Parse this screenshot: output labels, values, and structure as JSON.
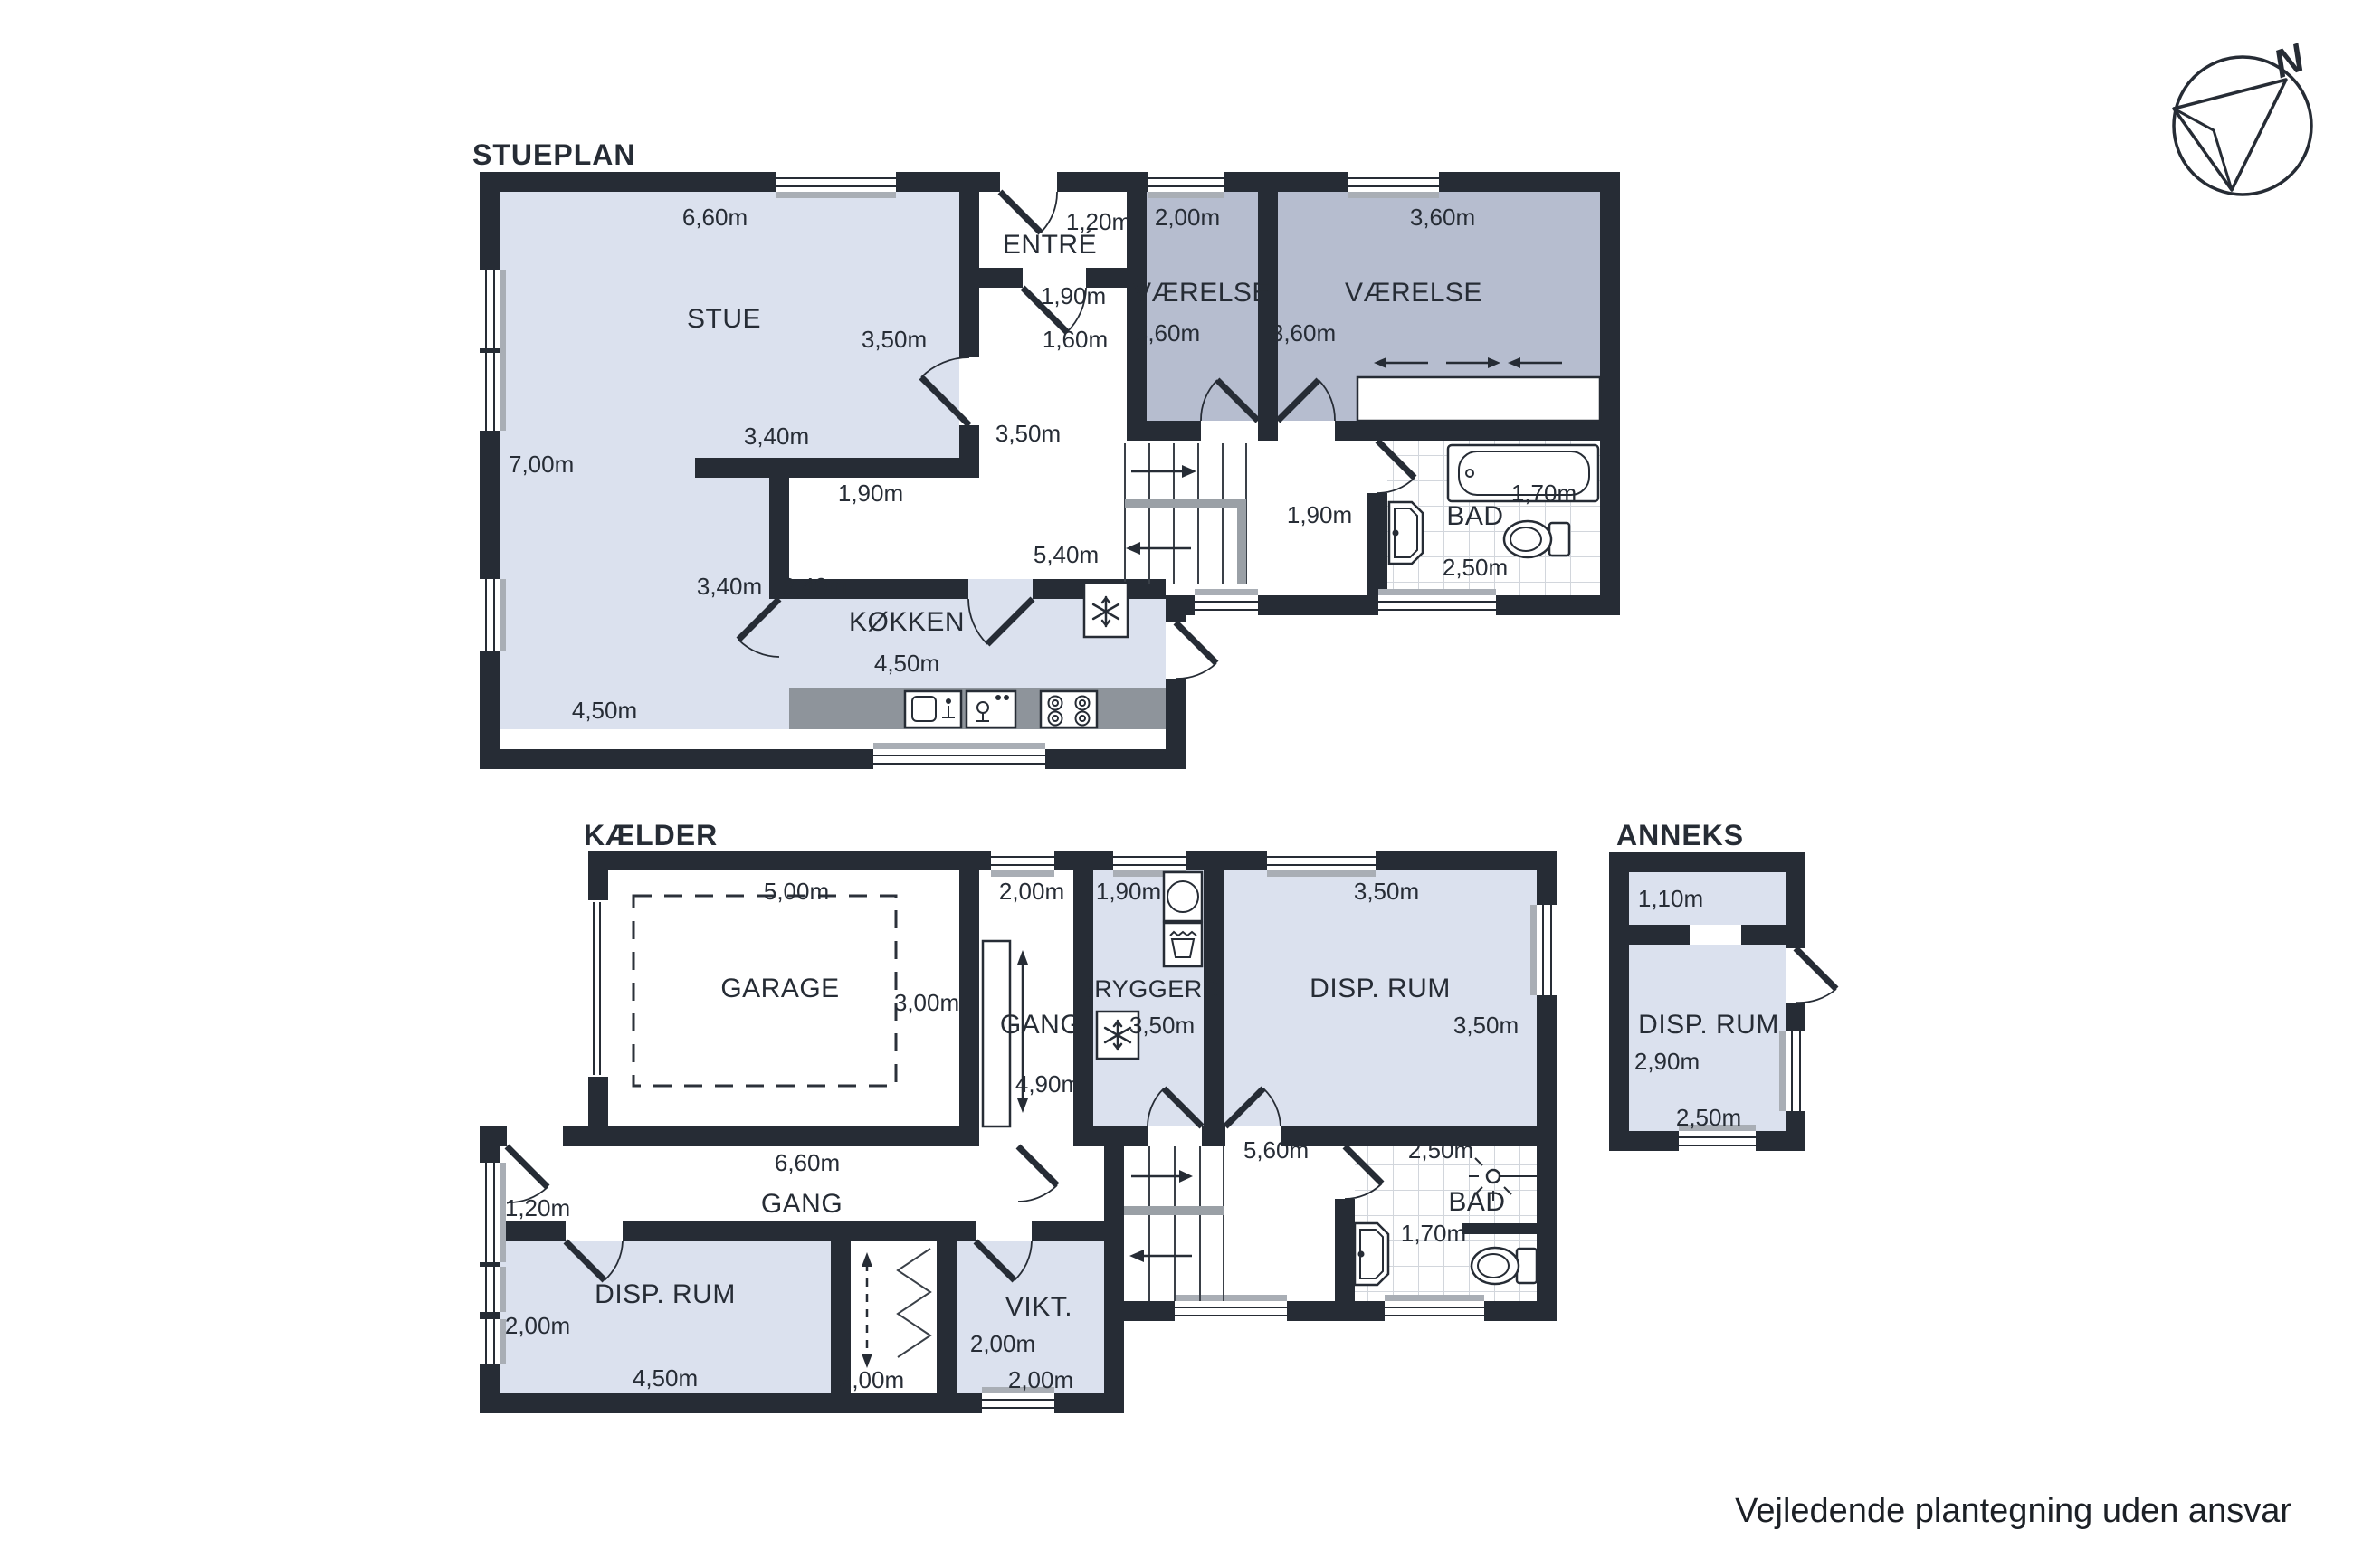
{
  "stueplan": {
    "title": "STUEPLAN",
    "stue": {
      "name": "STUE",
      "top": "6,60m",
      "left": "7,00m",
      "right": "3,50m",
      "mid_top": "3,40m",
      "mid_bottom": "1,90m",
      "door_left": "3,40m",
      "door_right": "3,40m",
      "bottom": "4,50m"
    },
    "entre": {
      "name": "ENTRÉ",
      "door": "1,20m",
      "inner_door": "1,90m",
      "passage": "1,60m"
    },
    "hall": {
      "width": "3,50m",
      "length": "5,40m",
      "bad_passage": "1,90m"
    },
    "vaerelse_1": {
      "name": "VÆRELSE",
      "top": "2,00m",
      "side": "3,60m"
    },
    "vaerelse_2": {
      "name": "VÆRELSE",
      "top": "3,60m",
      "side": "3,60m"
    },
    "bad": {
      "name": "BAD",
      "width": "1,70m",
      "bottom": "2,50m"
    },
    "koekken": {
      "name": "KØKKEN",
      "bottom": "4,50m"
    }
  },
  "kaelder": {
    "title": "KÆLDER",
    "garage": {
      "name": "GARAGE",
      "top": "5,00m",
      "side": "3,00m"
    },
    "gang_upper": {
      "name": "GANG",
      "top": "2,00m",
      "length": "4,90m"
    },
    "bryggers": {
      "name": "BRYGGERS",
      "top": "1,90m",
      "side": "3,50m"
    },
    "disp_rum": {
      "name": "DISP. RUM",
      "top": "3,50m",
      "side": "3,50m"
    },
    "gang_lower": {
      "name": "GANG",
      "top": "6,60m",
      "door": "1,20m"
    },
    "disp_rum_lower": {
      "name": "DISP. RUM",
      "side": "2,00m",
      "bottom": "4,50m"
    },
    "closet": {
      "bottom": "2,00m"
    },
    "vikt": {
      "name": "VIKT.",
      "side": "2,00m",
      "bottom": "2,00m"
    },
    "stair_hall": {
      "width": "5,60m"
    },
    "bad": {
      "name": "BAD",
      "top": "2,50m",
      "width": "1,70m"
    }
  },
  "anneks": {
    "title": "ANNEKS",
    "disp_rum": {
      "name": "DISP. RUM",
      "entry": "1,10m",
      "side": "2,90m",
      "bottom": "2,50m"
    }
  },
  "compass": {
    "north": "N"
  },
  "footer": {
    "disclaimer": "Vejledende plantegning uden ansvar"
  }
}
